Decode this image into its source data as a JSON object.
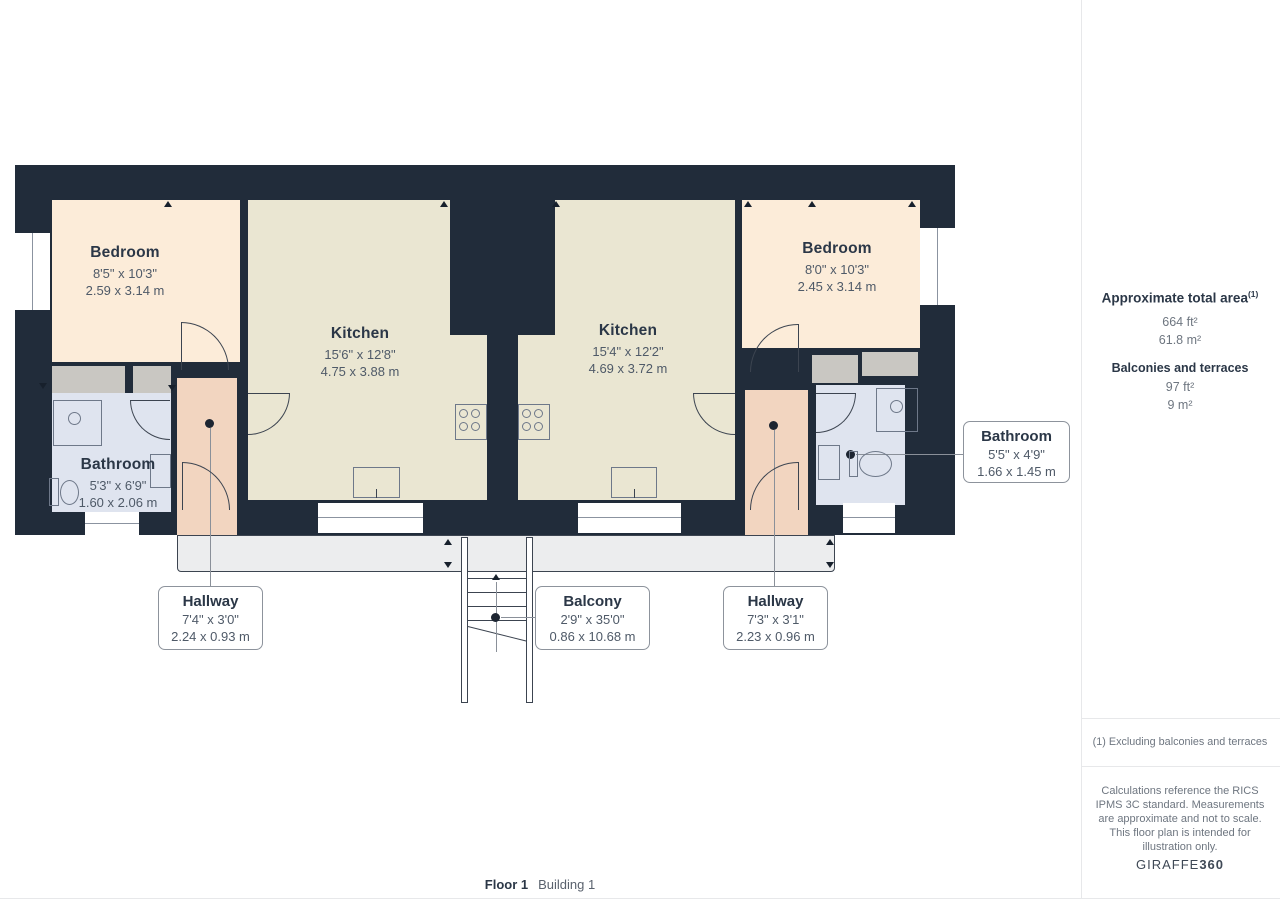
{
  "colors": {
    "wall": "#212c3a",
    "bedroom_fill": "#fcecd9",
    "kitchen_fill": "#eae6d2",
    "bathroom_fill": "#dfe4ef",
    "hallway_fill": "#f2d5c0",
    "closet_fill": "#c9c7c2",
    "balcony_fill": "#ecedee",
    "heading_text": "#2b3747",
    "dim_text": "#4f5a68"
  },
  "rooms": {
    "bedroom_left": {
      "name": "Bedroom",
      "dims_ft": "8'5\" x 10'3\"",
      "dims_m": "2.59 x 3.14 m"
    },
    "kitchen_left": {
      "name": "Kitchen",
      "dims_ft": "15'6\" x 12'8\"",
      "dims_m": "4.75 x 3.88 m"
    },
    "kitchen_right": {
      "name": "Kitchen",
      "dims_ft": "15'4\" x 12'2\"",
      "dims_m": "4.69 x 3.72 m"
    },
    "bedroom_right": {
      "name": "Bedroom",
      "dims_ft": "8'0\" x 10'3\"",
      "dims_m": "2.45 x 3.14 m"
    },
    "bathroom_left": {
      "name": "Bathroom",
      "dims_ft": "5'3\" x 6'9\"",
      "dims_m": "1.60 x 2.06 m"
    }
  },
  "callouts": {
    "bathroom_right": {
      "name": "Bathroom",
      "dims_ft": "5'5\" x 4'9\"",
      "dims_m": "1.66 x 1.45 m"
    },
    "hallway_left": {
      "name": "Hallway",
      "dims_ft": "7'4\" x 3'0\"",
      "dims_m": "2.24 x 0.93 m"
    },
    "balcony": {
      "name": "Balcony",
      "dims_ft": "2'9\" x 35'0\"",
      "dims_m": "0.86 x 10.68 m"
    },
    "hallway_right": {
      "name": "Hallway",
      "dims_ft": "7'3\" x 3'1\"",
      "dims_m": "2.23 x 0.96 m"
    }
  },
  "sidebar": {
    "total_area_label": "Approximate total area",
    "total_area_sup": "(1)",
    "total_area_ft": "664 ft²",
    "total_area_m": "61.8 m²",
    "balconies_label": "Balconies and terraces",
    "balconies_ft": "97 ft²",
    "balconies_m": "9 m²",
    "footnote": "(1) Excluding balconies and terraces",
    "disclaimer": "Calculations reference the RICS IPMS 3C standard. Measurements are approximate and not to scale. This floor plan is intended for illustration only.",
    "brand_name": "GIRAFFE",
    "brand_suffix": "360"
  },
  "footer": {
    "floor": "Floor 1",
    "building": "Building 1"
  }
}
